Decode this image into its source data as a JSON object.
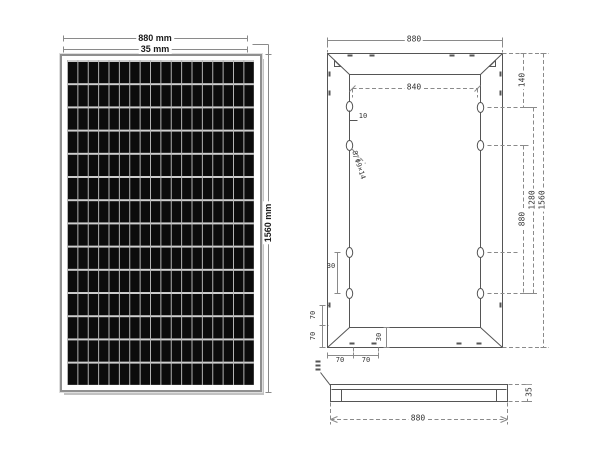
{
  "front_view": {
    "width_label": "880 mm",
    "frame_label": "35 mm",
    "height_label": "1560 mm",
    "grid_cols": 18,
    "grid_rows": 14
  },
  "rear_view": {
    "outer_width_label": "880",
    "inner_width_label": "840",
    "hole_offset_label": "10",
    "holes_note": "8/Φ9×14",
    "right_dim_140": "140",
    "right_dim_880": "880",
    "right_dim_1280": "1280",
    "right_dim_1560": "1560",
    "left_hole_gap_label": "30",
    "left_bottom_70_a": "70",
    "left_bottom_70_b": "70",
    "bottom_70_a": "70",
    "bottom_70_b": "70",
    "bottom_frame_label": "30"
  },
  "side_view": {
    "width_label": "880",
    "thickness_label": "35"
  },
  "colors": {
    "background": "#ffffff",
    "line": "#555555",
    "dim_line": "#8a8a8a",
    "label": "#1a1a1a",
    "cad_label": "#333333",
    "cell_black": "#0c0c0c",
    "grid_line_vertical": "#b5b5b5",
    "grid_line_horizontal": "#d0d0d0",
    "panel_frame": "#8f8f8f",
    "shadow": "#c2c2c2"
  }
}
